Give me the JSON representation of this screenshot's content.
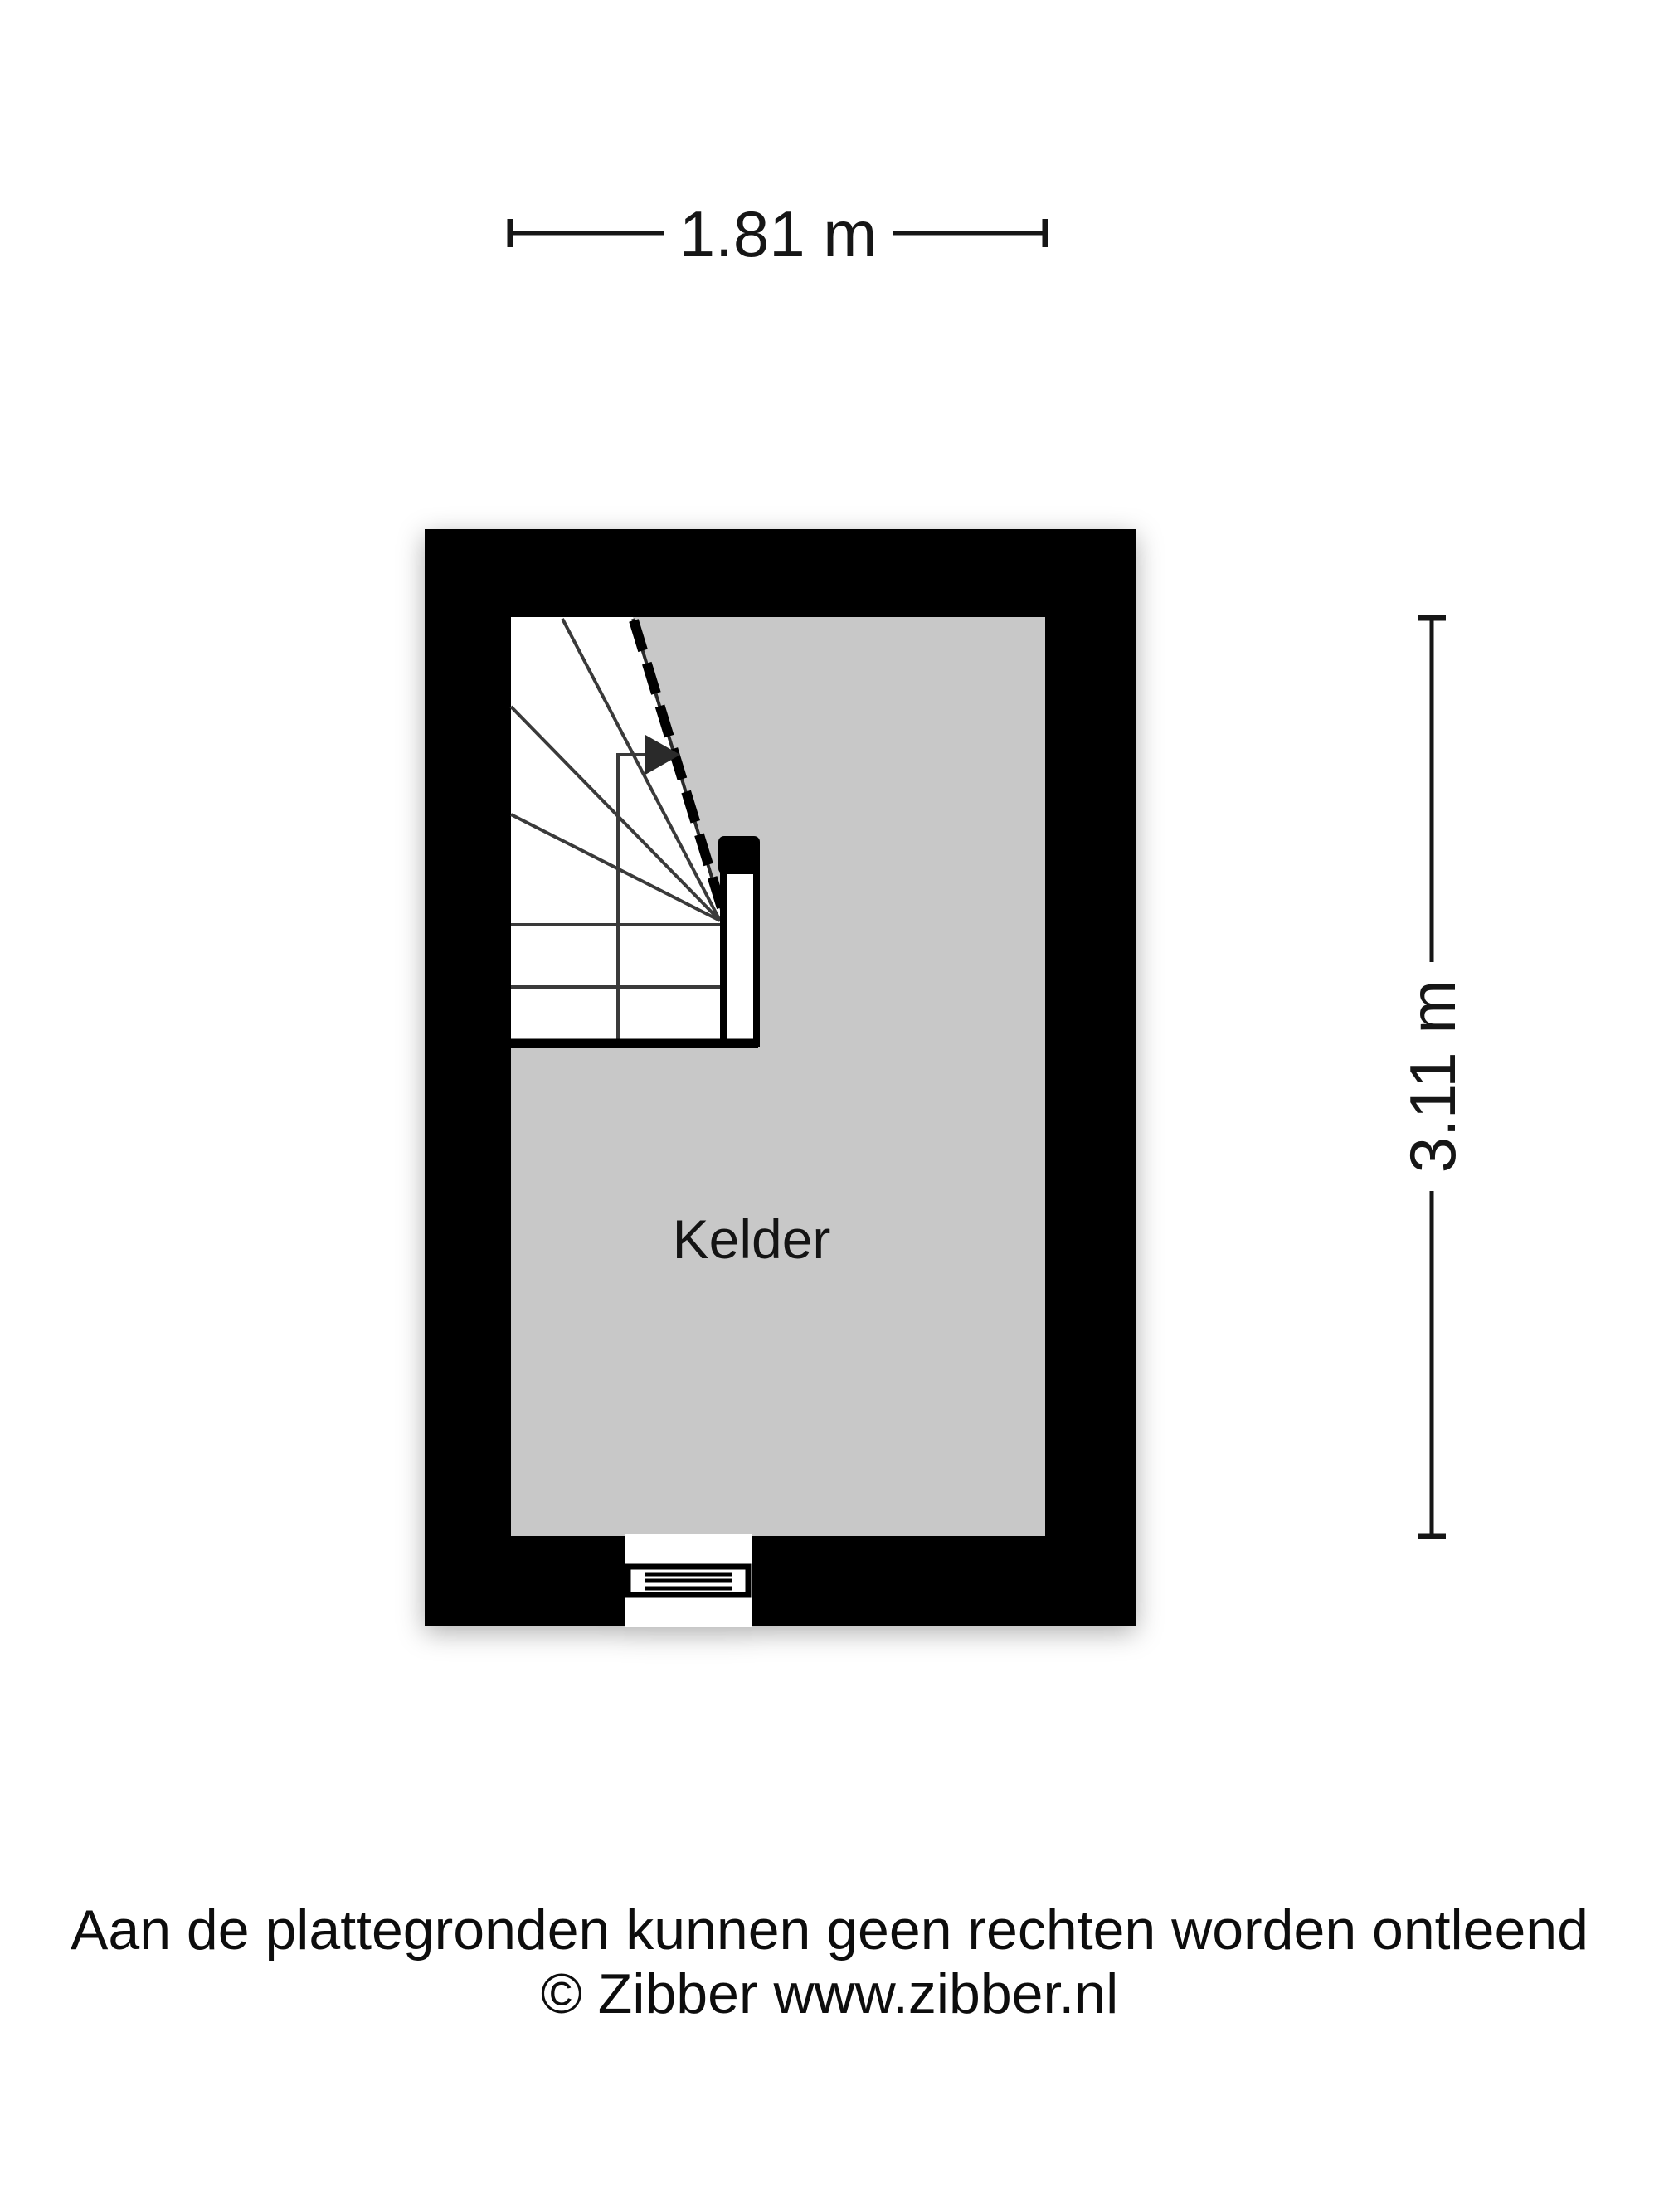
{
  "plan": {
    "room_label": "Kelder",
    "width_dimension": "1.81 m",
    "height_dimension": "3.11 m"
  },
  "footer": {
    "disclaimer": "Aan de plattegronden kunnen geen rechten worden ontleend",
    "copyright": "© Zibber www.zibber.nl"
  },
  "colors": {
    "wall": "#000000",
    "floor": "#c8c8c8",
    "stair_area": "#ffffff",
    "arrow": "#2a2a2a",
    "text": "#161616"
  }
}
